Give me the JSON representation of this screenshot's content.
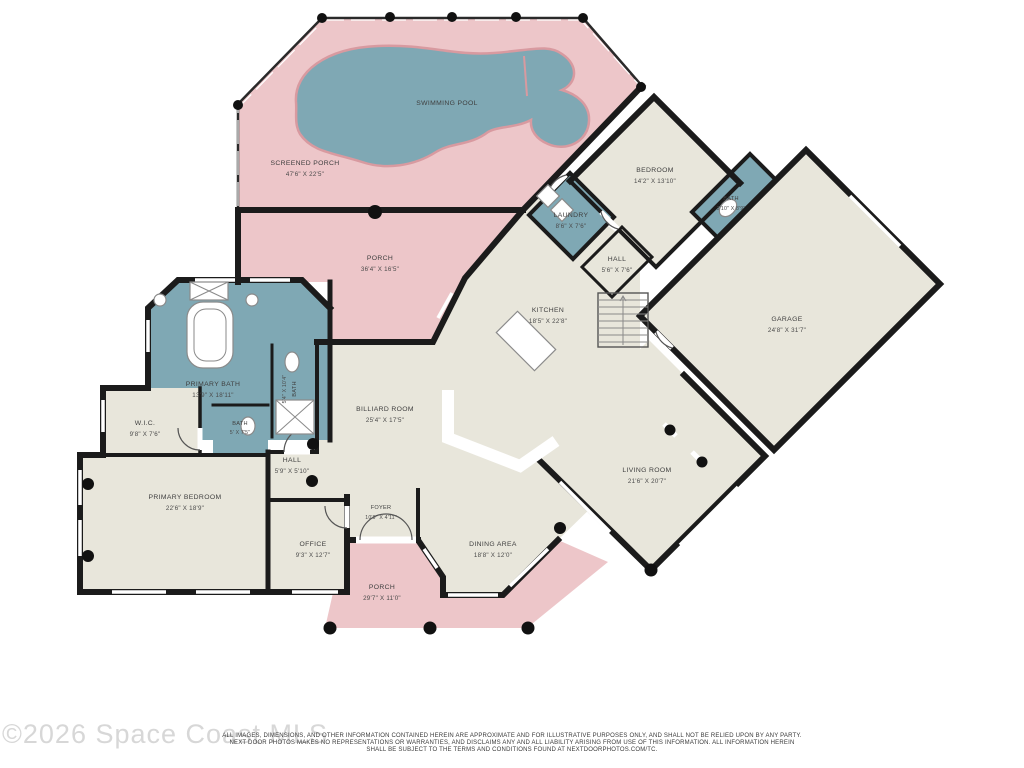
{
  "title": "Floor Plan",
  "watermark": "©2026 Space Coast MLS",
  "disclaimer": {
    "line1": "ALL IMAGES, DIMENSIONS, AND OTHER INFORMATION CONTAINED HEREIN ARE APPROXIMATE AND FOR ILLUSTRATIVE PURPOSES ONLY, AND SHALL NOT BE RELIED UPON BY ANY PARTY.",
    "line2": "NEXT DOOR PHOTOS MAKES NO REPRESENTATIONS OR WARRANTIES, AND DISCLAIMS ANY AND ALL LIABILITY ARISING FROM USE OF THIS INFORMATION. ALL INFORMATION HEREIN",
    "line3": "SHALL BE SUBJECT TO THE TERMS AND CONDITIONS FOUND AT NEXTDOORPHOTOS.COM/TC."
  },
  "colors": {
    "porch": "#edc6c9",
    "water": "#7fa8b4",
    "floor": "#e8e6db",
    "wall": "#1b1b1b",
    "pool_edge": "#d89aa0"
  },
  "rooms": [
    {
      "id": "swimming-pool",
      "name": "SWIMMING POOL",
      "dims": ""
    },
    {
      "id": "screened-porch",
      "name": "SCREENED PORCH",
      "dims": "47'6\" X 22'5\""
    },
    {
      "id": "porch-rear",
      "name": "PORCH",
      "dims": "36'4\" X 16'5\""
    },
    {
      "id": "laundry",
      "name": "LAUNDRY",
      "dims": "8'6\" X 7'6\""
    },
    {
      "id": "bedroom",
      "name": "BEDROOM",
      "dims": "14'2\" X 13'10\""
    },
    {
      "id": "bath-guest",
      "name": "BATH",
      "dims": "3'10\" X 8'9\""
    },
    {
      "id": "hall-rear",
      "name": "HALL",
      "dims": "5'6\" X 7'6\""
    },
    {
      "id": "kitchen",
      "name": "KITCHEN",
      "dims": "18'5\" X 22'8\""
    },
    {
      "id": "garage",
      "name": "GARAGE",
      "dims": "24'8\" X 31'7\""
    },
    {
      "id": "primary-bath",
      "name": "PRIMARY BATH",
      "dims": "13'9\" X 18'11\""
    },
    {
      "id": "bath-vertical",
      "name": "BATH",
      "dims": "5'4\" X 10'4\""
    },
    {
      "id": "wic",
      "name": "W.I.C.",
      "dims": "9'8\" X 7'6\""
    },
    {
      "id": "bath-small",
      "name": "BATH",
      "dims": "5' X 7'5\""
    },
    {
      "id": "hall-center",
      "name": "HALL",
      "dims": "5'9\" X 5'10\""
    },
    {
      "id": "billiard-room",
      "name": "BILLIARD ROOM",
      "dims": "25'4\" X 17'5\""
    },
    {
      "id": "primary-bedroom",
      "name": "PRIMARY BEDROOM",
      "dims": "22'6\" X 18'9\""
    },
    {
      "id": "office",
      "name": "OFFICE",
      "dims": "9'3\" X 12'7\""
    },
    {
      "id": "foyer",
      "name": "FOYER",
      "dims": "10'9\" X 4'11\""
    },
    {
      "id": "dining-area",
      "name": "DINING AREA",
      "dims": "18'8\" X 12'0\""
    },
    {
      "id": "living-room",
      "name": "LIVING ROOM",
      "dims": "21'6\" X 20'7\""
    },
    {
      "id": "porch-front",
      "name": "PORCH",
      "dims": "29'7\" X 11'0\""
    }
  ]
}
